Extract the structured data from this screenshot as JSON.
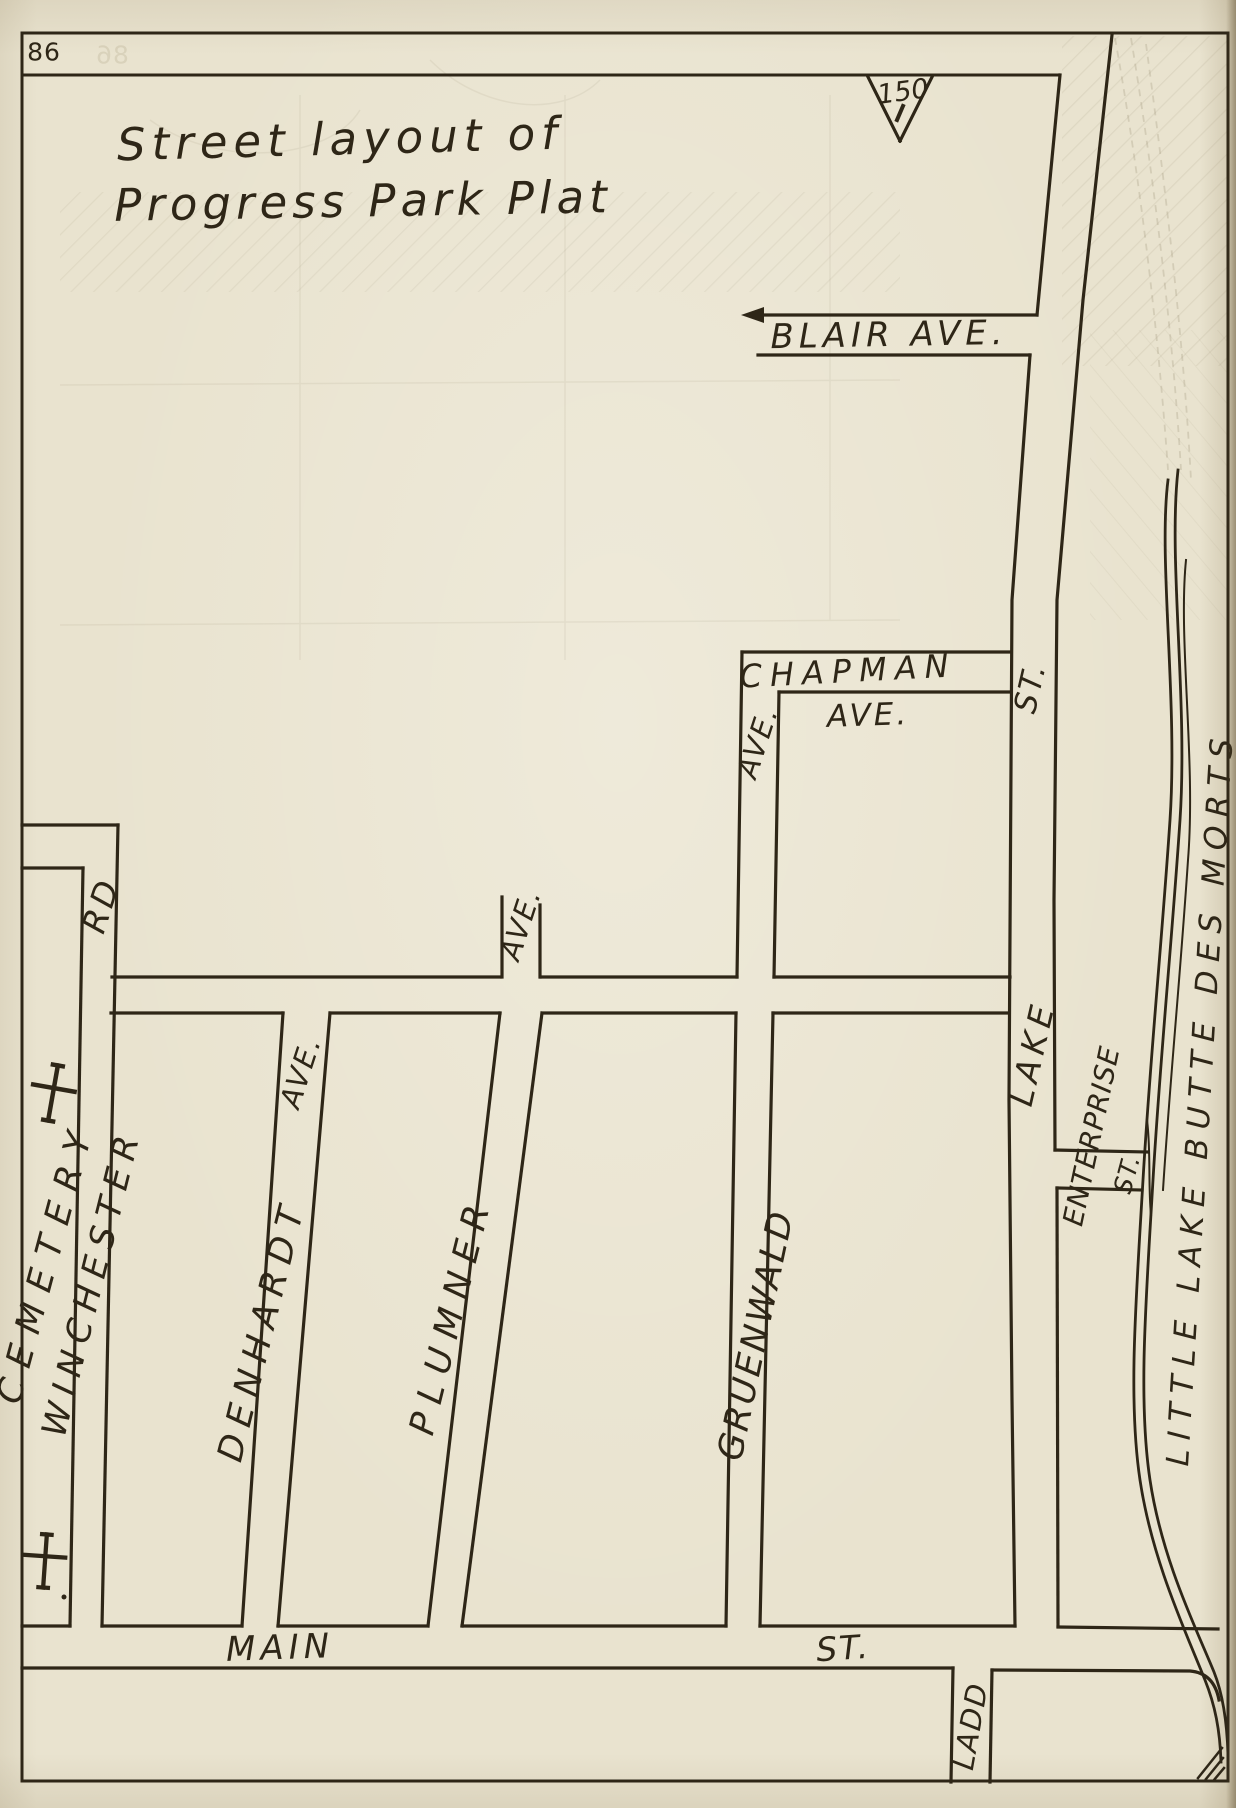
{
  "page": {
    "number": "86"
  },
  "title": {
    "line1": "Street layout of",
    "line2": "Progress Park Plat"
  },
  "marker": {
    "distance": "150"
  },
  "roads": {
    "blair": "BLAIR AVE.",
    "chapman": "CHAPMAN",
    "chapman_ave": "AVE.",
    "cemetery": "CEMETERY",
    "cemetery_rd": "RD",
    "winchester": "WINCHESTER",
    "denhardt": "DENHARDT",
    "denhardt_ave": "AVE.",
    "plumner": "PLUMNER",
    "plumner_ave": "AVE.",
    "gruenwald": "GRUENWALD",
    "gruenwald_ave": "AVE.",
    "lake": "LAKE",
    "lake_st": "ST.",
    "enterprise": "ENTERPRISE",
    "enterprise_st": "ST.",
    "main": "MAIN",
    "main_st": "ST.",
    "ladd": "LADD"
  },
  "water": {
    "name": "LITTLE LAKE BUTTE DES MORTS"
  },
  "symbols": {
    "cross": "cemetery-cross",
    "survey_triangle": "150-foot-survey-marker"
  },
  "colors": {
    "paper": "#e9e3cf",
    "ink": "#2e2617"
  }
}
